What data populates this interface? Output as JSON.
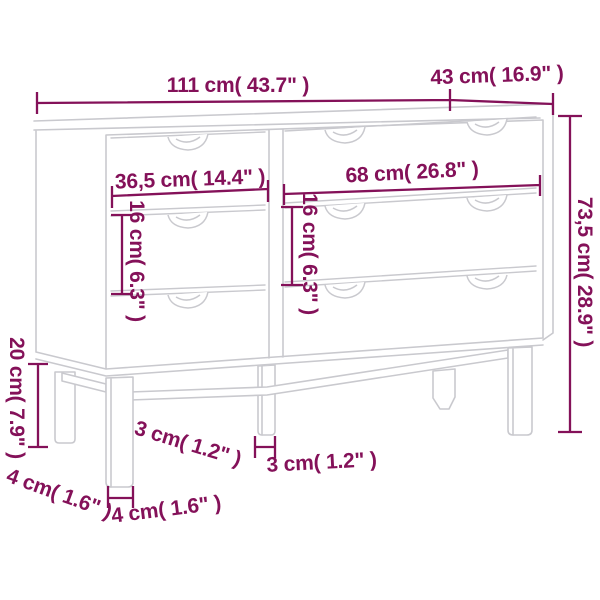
{
  "diagram": {
    "title": "furniture-dimension-diagram",
    "subject": "sideboard with six drawers on legs, line drawing",
    "colors": {
      "dimension_accent": "#841159",
      "line_art": "#c9c9ce",
      "background": "#ffffff"
    },
    "labels": {
      "top_width": "111 cm( 43.7\" )",
      "top_depth": "43 cm( 16.9\" )",
      "left_drawer_width": "36,5 cm( 14.4\" )",
      "right_drawer_width": "68 cm( 26.8\" )",
      "left_drawer_height": "16 cm( 6.3\" )",
      "right_drawer_height": "16 cm( 6.3\" )",
      "overall_height": "73,5 cm( 28.9\" )",
      "leg_height": "20 cm( 7.9\" )",
      "middle_leg_thickness_rotated": "3 cm( 1.2\" )",
      "middle_leg_thickness": "3 cm( 1.2\" )",
      "front_leg_thickness_rotated": "4 cm( 1.6\" )",
      "front_leg_thickness": "4 cm( 1.6\" )"
    }
  }
}
